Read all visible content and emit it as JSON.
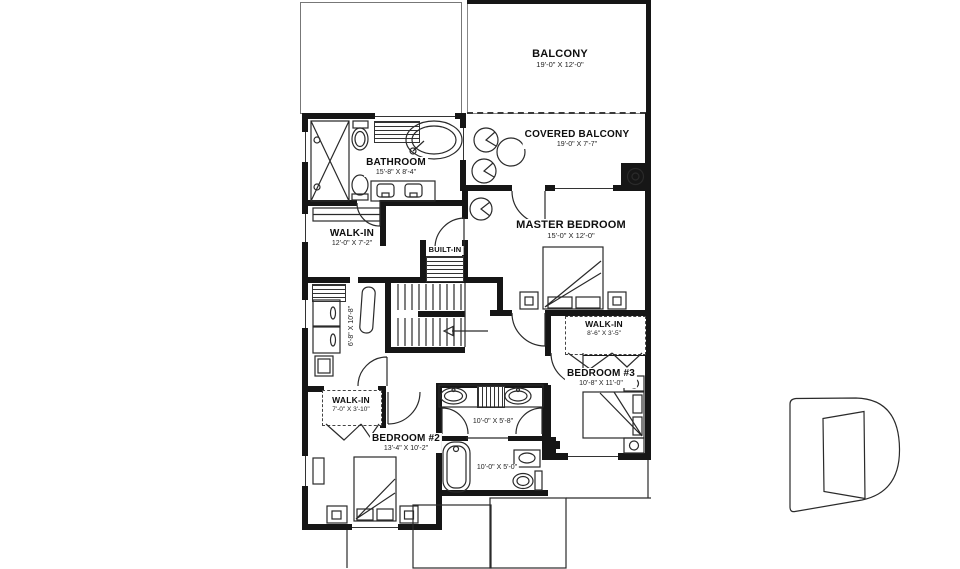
{
  "rooms": {
    "balcony": {
      "name": "BALCONY",
      "dims": "19'-0\" X 12'-0\""
    },
    "covered_balcony": {
      "name": "COVERED BALCONY",
      "dims": "19'-0\" X 7'-7\""
    },
    "bathroom": {
      "name": "BATHROOM",
      "dims": "15'-8\" X 8'-4\""
    },
    "walkin_master": {
      "name": "WALK-IN",
      "dims": "12'-0\" X 7'-2\""
    },
    "master_bedroom": {
      "name": "MASTER BEDROOM",
      "dims": "15'-0\" X 12'-0\""
    },
    "walkin_bedroom3": {
      "name": "WALK-IN",
      "dims": "8'-6\" X 3'-5\""
    },
    "bedroom3": {
      "name": "BEDROOM #3",
      "dims": "10'-8\" X 11'-0\""
    },
    "walkin_bedroom2": {
      "name": "WALK-IN",
      "dims": "7'-0\" X 3'-10\""
    },
    "bedroom2": {
      "name": "BEDROOM #2",
      "dims": "13'-4\" X 10'-2\""
    },
    "laundry_area": {
      "dims": "6'-8\" X 10'-8\""
    },
    "bathroom2": {
      "dims": "10'-0\" X 5'-8\""
    },
    "bathroom3": {
      "dims": "10'-0\" X 5'-0\""
    },
    "built_in": {
      "label": "BUILT-IN"
    }
  },
  "colors": {
    "wall": "#161616",
    "line": "#2a2a2a",
    "roof_line": "#777777",
    "watermark": "#e2e2e2"
  }
}
